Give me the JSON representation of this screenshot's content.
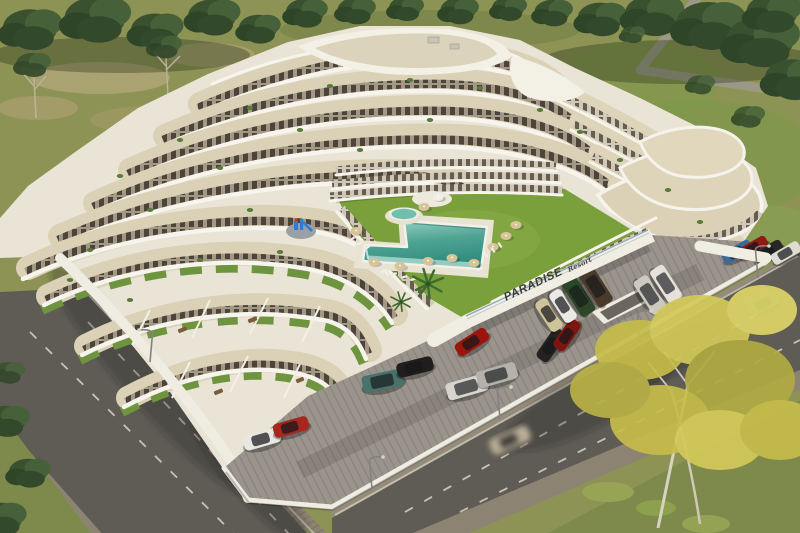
{
  "scene": {
    "title": "Aerial 3D architectural render of a white terraced apartment resort",
    "sign": {
      "brand": "PARADISE",
      "script_word": "Resort"
    },
    "palette": {
      "field_olive": "#8d9355",
      "lawn_green": "#7aa03c",
      "building_white": "#f6f4ec",
      "terrace_beige": "#dbd1b7",
      "pool_turquoise": "#4fa493",
      "asphalt": "#5f5c55",
      "paver_gray": "#9a948d",
      "sidewalk_brown": "#8d8373",
      "autumn_tree_yellow": "#c9bf4e",
      "playground_blue": "#2e7cd6"
    },
    "elements": [
      "terraced-apartment-building",
      "courtyard-lawn",
      "l-shaped-pool",
      "kids-pool",
      "round-patio",
      "playground",
      "parking-lot",
      "perimeter-roads",
      "street-lamps",
      "tree-line",
      "autumn-tree",
      "parked-cars",
      "moving-car",
      "paradise-sign-wall"
    ]
  }
}
